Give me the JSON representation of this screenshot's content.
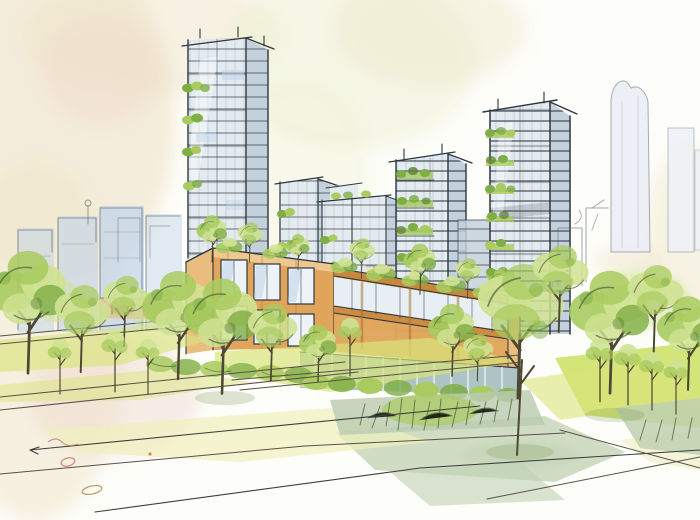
{
  "meta": {
    "alt": "Watercolor and ink architectural concept sketch of a sustainable urban district: glass high-rise towers with planted green balconies rise behind a low timber-and-glass podium building with roof gardens, fronted by a park of young trees, terraced yellow-green lawns, shrub planting beds and loosely sketched footpaths; a faint blue watercolor skyline and soft cream and blush washes fill the background.",
    "medium": "watercolor-and-ink-sketch"
  },
  "scene": {
    "background": {
      "washes": [
        "cream wash top-left",
        "blush pink hint",
        "pale green-yellow wash top-center",
        "cream hint right edge"
      ],
      "skyline_left": "faint blue watercolor towers with loose ink outlines",
      "skyline_right": "pale ghosted high-rise silhouettes"
    },
    "midground": {
      "towers": [
        "hero glass tower with green balconies",
        "mid-rise glass tower",
        "wide glass block with stepped roof",
        "tall tower with stacked green terraces",
        "rightmost dark-framed tower with planted balconies"
      ],
      "podium": "timber-and-glass podium with roof garden and glazed storefront"
    },
    "foreground": {
      "park": "rows of young trees over bright lawns",
      "beds": "shrub and tall-grass planting beds",
      "paths": "white footpaths with long sketched construction lines and small pen doodles"
    }
  },
  "palette": {
    "paper": "#fdfdf9",
    "ink": "#2e3740",
    "ink-soft": "#55616c",
    "wash-cream": "#eee3c6",
    "wash-pink": "#edd8cb",
    "wash-green": "#edf0d2",
    "glass-light": "#e3ebf1",
    "glass-mid": "#c4d1dc",
    "glass-blue": "#bfd3ea",
    "glass-deep": "#9fb3c2",
    "wood-light": "#e0a55a",
    "wood-mid": "#c8873c",
    "wood-dark": "#a96f2e",
    "wood-top": "#eec88f",
    "foliage-light": "#cfe292",
    "foliage-mid": "#a9cb5f",
    "foliage-dark": "#7fae45",
    "foliage-deep": "#5c8034",
    "lawn": "#d9e47c",
    "lawn-bright": "#cbdf63",
    "sage": "#c0d1b2",
    "trunk": "#4d4733",
    "path-line": "#5a5148",
    "storefront": "#a5bdbc",
    "tan": "#e2c196",
    "buff": "#ebdfc0"
  }
}
